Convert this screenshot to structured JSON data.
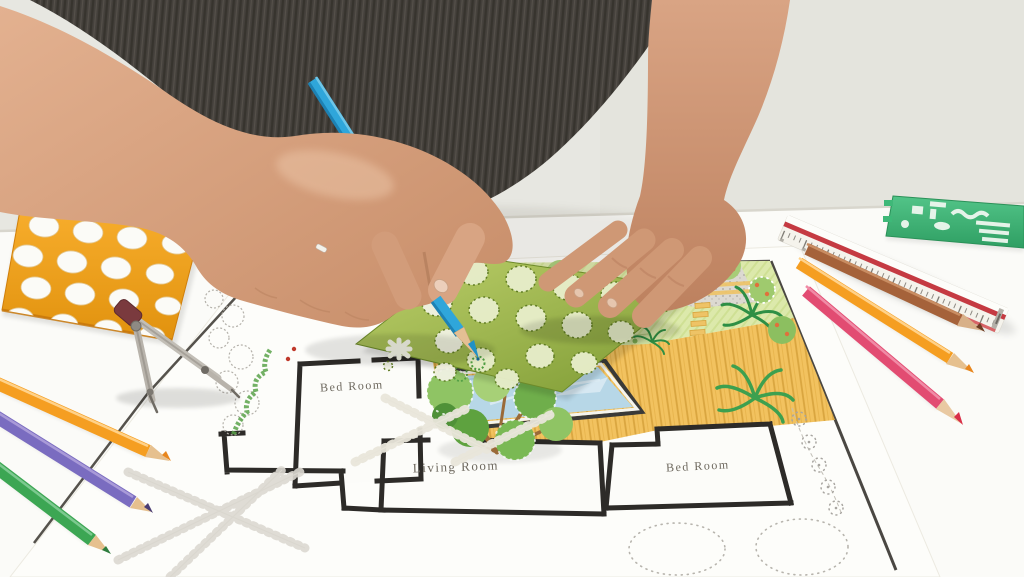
{
  "scene_title": "Landscape architect drawing a backyard garden design plan",
  "plan": {
    "labels": {
      "bedroom_left": "Bed Room",
      "living_room": "Living Room",
      "bedroom_right": "Bed Room",
      "pool": "Pool"
    }
  },
  "tools": [
    {
      "name": "circle-template",
      "color": "#f2a224"
    },
    {
      "name": "drawing-compass",
      "color": "#8e8a84"
    },
    {
      "name": "pencil-orange-left",
      "color": "#f59e21"
    },
    {
      "name": "pencil-purple",
      "color": "#7a6cc0"
    },
    {
      "name": "pencil-green",
      "color": "#3ca653"
    },
    {
      "name": "pencil-blue-in-hand",
      "color": "#2fa6da"
    },
    {
      "name": "pencil-brown",
      "color": "#a5623a"
    },
    {
      "name": "pencil-orange-right",
      "color": "#f59e21"
    },
    {
      "name": "pencil-pink",
      "color": "#e24c72"
    },
    {
      "name": "tree-symbol-stencil",
      "color": "#8aa93c"
    },
    {
      "name": "landscape-symbol-template",
      "color": "#3eb878"
    },
    {
      "name": "triangular-scale-ruler",
      "color": "#f5f3ec"
    }
  ],
  "palette": {
    "wall": "#e7e7e1",
    "table": "#fbfbf8",
    "shirt": "#45413c",
    "skin": "#d6a385",
    "lawn": "#dce9ab",
    "deck": "#f2c25f",
    "pool_water": "#b7d7e7",
    "plan_wall_line": "#2d2b28",
    "ruler_stripe": "#c53a42"
  }
}
